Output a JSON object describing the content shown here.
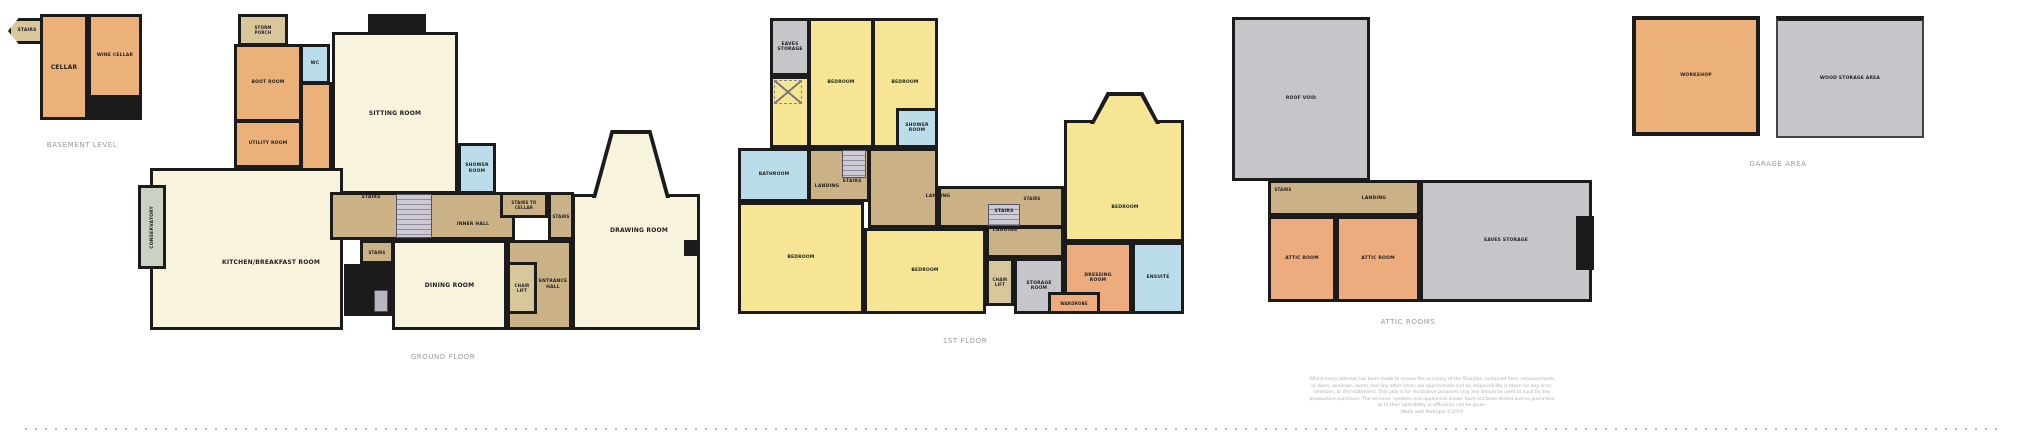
{
  "floors": {
    "basement": {
      "caption": "BASEMENT LEVEL",
      "rooms": {
        "stairs": "STAIRS",
        "cellar": "CELLAR",
        "wine_cellar": "WINE CELLAR"
      }
    },
    "ground": {
      "caption": "GROUND FLOOR",
      "rooms": {
        "storm_porch": "STORM PORCH",
        "boot_room": "BOOT ROOM",
        "wc": "WC",
        "utility_room": "UTILITY ROOM",
        "sitting_room": "SITTING ROOM",
        "shower_room": "SHOWER ROOM",
        "conservatory": "CONSERVATORY",
        "kitchen_breakfast_room": "KITCHEN/BREAKFAST ROOM",
        "inner_hall": "INNER HALL",
        "stairs_upper": "STAIRS",
        "stairs_lower": "STAIRS",
        "stairs_to_cellar": "STAIRS TO CELLAR",
        "stairs_side": "STAIRS",
        "dining_room": "DINING ROOM",
        "chair_lift": "CHAIR LIFT",
        "entrance_hall": "ENTRANCE HALL",
        "drawing_room": "DRAWING ROOM"
      }
    },
    "first": {
      "caption": "1ST FLOOR",
      "rooms": {
        "eaves_storage": "EAVES STORAGE",
        "bedroom_1": "BEDROOM",
        "bedroom_2": "BEDROOM",
        "shower_room": "SHOWER ROOM",
        "bathroom": "BATHROOM",
        "landing_1": "LANDING",
        "stairs_1": "STAIRS",
        "bedroom_3": "BEDROOM",
        "bedroom_4": "BEDROOM",
        "landing_2": "LANDING",
        "stairs_2": "STAIRS",
        "stairs_3": "STAIRS",
        "landing_3": "LANDING",
        "bedroom_5": "BEDROOM",
        "chair_lift": "CHAIR LIFT",
        "storage_room": "STORAGE ROOM",
        "wardrobe": "WARDROBE",
        "dressing_room": "DRESSING ROOM",
        "ensuite": "ENSUITE"
      }
    },
    "attic": {
      "caption": "ATTIC ROOMS",
      "rooms": {
        "roof_void": "ROOF VOID",
        "stairs": "STAIRS",
        "landing": "LANDING",
        "attic_room_1": "ATTIC ROOM",
        "attic_room_2": "ATTIC ROOM",
        "eaves_storage": "EAVES STORAGE"
      }
    },
    "garage": {
      "caption": "GARAGE AREA",
      "rooms": {
        "workshop": "WORKSHOP",
        "wood_storage_area": "WOOD STORAGE AREA"
      }
    }
  },
  "disclaimer": {
    "lines": [
      "Whilst every attempt has been made to ensure the accuracy of the floorplan contained here, measurements",
      "of doors, windows, rooms and any other items are approximate and no responsibility is taken for any error,",
      "omission, or mis-statement. This plan is for illustrative purposes only and should be used as such by any",
      "prospective purchaser. The services, systems and appliances shown have not been tested and no guarantee",
      "as to their operability or efficiency can be given."
    ],
    "credit": "Made with Metropix ©2019"
  },
  "colors": {
    "wall": "#1b1b1b",
    "room_cream": "#F8F3DC",
    "bedroom_yellow": "#F5E595",
    "room_orange": "#EBB179",
    "room_salmon": "#EDAC7E",
    "wet_room_blue": "#BADDE9",
    "hall_tan": "#CBB186",
    "storage_gray": "#C5C5CA",
    "conservatory_green": "#C9D2C5",
    "caption_text": "#9a9a9a",
    "disclaimer_text": "#b3b0ac",
    "dotted_line_green": "#a9c9a9"
  }
}
